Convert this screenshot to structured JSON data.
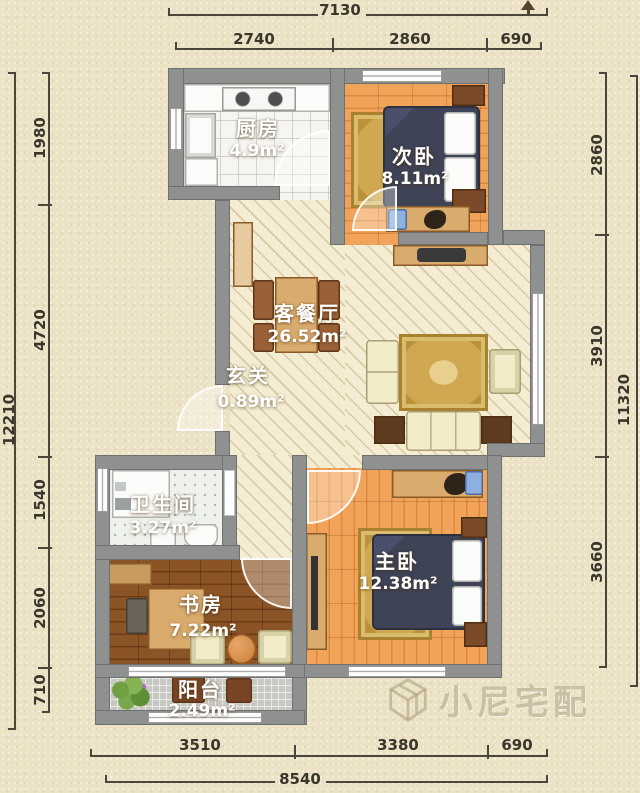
{
  "plan": {
    "rooms": {
      "kitchen": {
        "name": "厨房",
        "area": "4.9m²"
      },
      "second_bedroom": {
        "name": "次卧",
        "area": "8.11m²"
      },
      "living_dining": {
        "name": "客餐厅",
        "area": "26.52m²"
      },
      "entrance": {
        "name": "玄关",
        "area": "0.89m²"
      },
      "bathroom": {
        "name": "卫生间",
        "area": "3.27m²"
      },
      "study": {
        "name": "书房",
        "area": "7.22m²"
      },
      "master_bedroom": {
        "name": "主卧",
        "area": "12.38m²"
      },
      "balcony": {
        "name": "阳台",
        "area": "2.49m²"
      }
    },
    "dimensions": {
      "top": {
        "total": "7130",
        "segments": [
          "2740",
          "2860",
          "690"
        ]
      },
      "bottom": {
        "total": "8540",
        "segments": [
          "3510",
          "3380",
          "690"
        ]
      },
      "left": {
        "total": "12210",
        "segments": [
          "1980",
          "4720",
          "1540",
          "2060",
          "710"
        ]
      },
      "right": {
        "total": "11320",
        "segments": [
          "2860",
          "3910",
          "3660"
        ]
      }
    },
    "watermark": "小尼宅配",
    "colors": {
      "background": "#ece3c6",
      "wall": "#8f9090",
      "wood_floor": "#ee9b51",
      "dark_wood_floor": "#7c4a22",
      "hatch_floor": "#f4edd3",
      "bed": "#3e4356",
      "rug": "#cfa851",
      "sofa": "#f2ecc9"
    }
  }
}
